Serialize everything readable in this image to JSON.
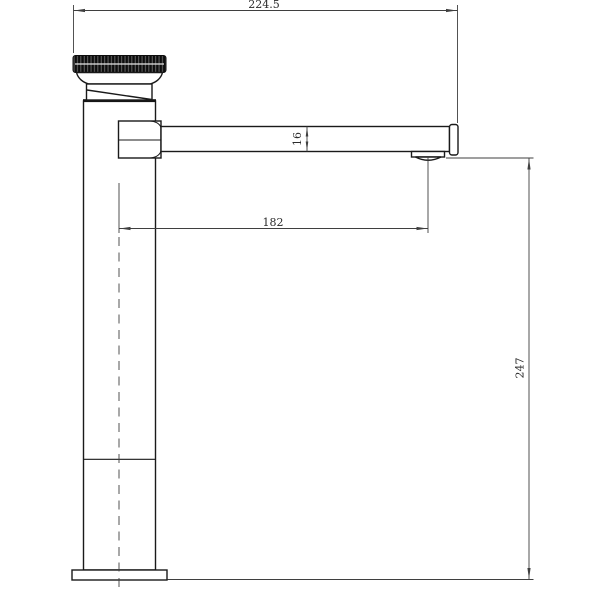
{
  "drawing": {
    "kind": "technical-dimension-drawing",
    "subject": "single-handle tall basin faucet, side elevation",
    "units": "mm",
    "background_color": "#ffffff",
    "object_line_color": "#1a1a1a",
    "dimension_line_color": "#3f3f3f",
    "dimensions": {
      "overall_width": "224.5",
      "spout_section_height": "16",
      "spout_reach": "182",
      "overall_height": "247"
    }
  }
}
